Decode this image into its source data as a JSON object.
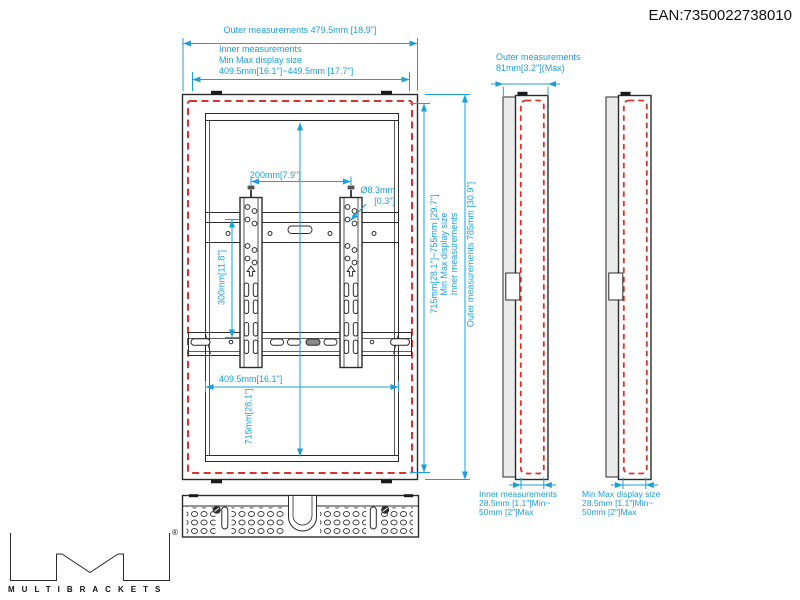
{
  "ean": "EAN:7350022738010",
  "colors": {
    "dim": "#1e9fd9",
    "red": "#d8322e",
    "ink": "#1a1a1a"
  },
  "front_view": {
    "top_outer": "Outer measurements 479.5mm [18.9\"]",
    "top_inner_lines": [
      "Inner measurements",
      "Min Max display size",
      "409.5mm[16.1\"]~449.5mm [17.7\"]"
    ],
    "hole_spacing": "200mm[7.9\"]",
    "hole_dia_lines": [
      "Ø8.3mm",
      "[0.3\"]"
    ],
    "rail_height": "300mm[11.8\"]",
    "inner_width": "409.5mm[16.1\"]",
    "inner_height": "715mm[28.1\"]",
    "right_inner_lines": [
      "Inner measurements",
      "Min Max display size",
      "715mm[28.1\"]~755mm [29.7\"]"
    ],
    "right_outer": "Outer measurements 785mm [30.9\"]"
  },
  "side_views": {
    "depth_lines": [
      "Outer measurements",
      "81mm[3.2\"](Max)"
    ],
    "inner_depth_lines": [
      "Inner measurements",
      "28.5mm [1.1\"]Min~",
      "50mm [2\"]Max"
    ],
    "display_depth_lines": [
      "Min Max display size",
      "28.5mm [1.1\"]Min~",
      "50mm [2\"]Max"
    ]
  },
  "logo": {
    "brand": "MULTIBRACKETS",
    "registered": "®"
  }
}
